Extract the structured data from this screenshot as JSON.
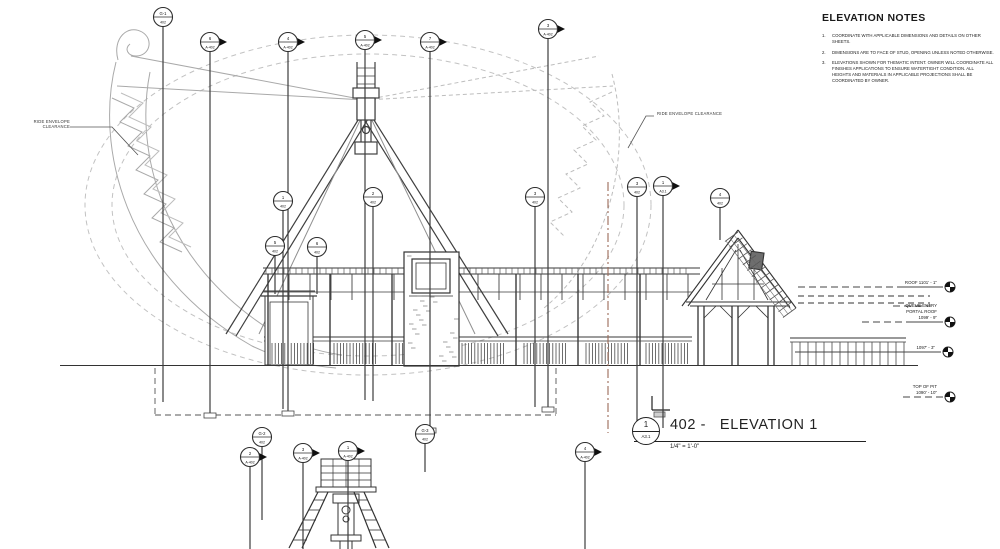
{
  "notes": {
    "title": "ELEVATION NOTES",
    "items": [
      {
        "num": "1.",
        "text": "COORDINATE WITH APPLICABLE DIMENSIONS AND DETAILS ON OTHER SHEETS."
      },
      {
        "num": "2.",
        "text": "DIMENSIONS ARE TO FACE OF STUD, OPENING UNLESS NOTED OTHERWISE."
      },
      {
        "num": "3.",
        "text": "ELEVATIONS SHOWN FOR THEMATIC INTENT.  OWNER WILL COORDINATE ALL FINISHES APPLICATIONS TO ENSURE WATERTIGHT CONDITION.  ALL HEIGHTS AND MATERIALS IN APPLICABLE PROJECTIONS SHALL BE COORDINATED BY OWNER."
      }
    ]
  },
  "labels": {
    "ride_envelope_left_line1": "RIDE ENVELOPE",
    "ride_envelope_left_line2": "CLEARANCE",
    "ride_envelope_right": "RIDE ENVELOPE CLEARANCE"
  },
  "title_block": {
    "detail_number": "1",
    "sheet_ref": "A3.1",
    "name": "402 -   ELEVATION 1",
    "scale": "1/4\" = 1'-0\""
  },
  "elevation_tags": [
    {
      "lines": [
        "ROOF 1101' - 1\""
      ],
      "x": 950,
      "y": 287
    },
    {
      "lines": [
        "QUEUE ENTRY",
        "PORTAL ROOF",
        "1099' - 9\""
      ],
      "x": 950,
      "y": 322
    },
    {
      "lines": [
        "1097' - 3\""
      ],
      "x": 948,
      "y": 352
    },
    {
      "lines": [
        "TOP OF PIT",
        "1090' - 10\""
      ],
      "x": 950,
      "y": 397
    }
  ],
  "markers": [
    {
      "kind": "grid",
      "top": "G-1",
      "bot": "402",
      "x": 163,
      "y": 17,
      "stem": 402
    },
    {
      "kind": "section",
      "top": "6",
      "bot": "A-402",
      "x": 210,
      "y": 42,
      "stem": 413,
      "box": true
    },
    {
      "kind": "section",
      "top": "4",
      "bot": "A-402",
      "x": 288,
      "y": 42,
      "stem": 411,
      "box": true
    },
    {
      "kind": "section",
      "top": "5",
      "bot": "A-402",
      "x": 365,
      "y": 40,
      "stem": 400
    },
    {
      "kind": "section",
      "top": "7",
      "bot": "A-402",
      "x": 430,
      "y": 42,
      "stem": 428,
      "box": true
    },
    {
      "kind": "section",
      "top": "3",
      "bot": "A-402",
      "x": 548,
      "y": 29,
      "stem": 407,
      "box": true
    },
    {
      "kind": "section",
      "top": "1",
      "bot": "A3.1",
      "x": 663,
      "y": 186,
      "stem": 428
    },
    {
      "kind": "grid",
      "top": "4",
      "bot": "402",
      "x": 720,
      "y": 198,
      "stem": 240
    },
    {
      "kind": "grid",
      "top": "1",
      "bot": "402",
      "x": 283,
      "y": 201,
      "stem": 409
    },
    {
      "kind": "grid",
      "top": "2",
      "bot": "402",
      "x": 373,
      "y": 197,
      "stem": 401
    },
    {
      "kind": "grid",
      "top": "3",
      "bot": "402",
      "x": 535,
      "y": 197,
      "stem": 407
    },
    {
      "kind": "grid",
      "top": "3",
      "bot": "402",
      "x": 637,
      "y": 187,
      "stem": 428
    },
    {
      "kind": "grid",
      "top": "5",
      "bot": "402",
      "x": 275,
      "y": 246,
      "stem": 294
    },
    {
      "kind": "grid",
      "top": "6",
      "bot": "402",
      "x": 317,
      "y": 247,
      "stem": 294
    },
    {
      "kind": "grid",
      "top": "G-2",
      "bot": "402",
      "x": 262,
      "y": 437,
      "stem": 520
    },
    {
      "kind": "section",
      "top": "2",
      "bot": "A-402",
      "x": 250,
      "y": 457,
      "stem": 549
    },
    {
      "kind": "section",
      "top": "3",
      "bot": "A-402",
      "x": 303,
      "y": 453,
      "stem": 549
    },
    {
      "kind": "section",
      "top": "1",
      "bot": "A-402",
      "x": 348,
      "y": 451,
      "stem": 549
    },
    {
      "kind": "grid",
      "top": "G-3",
      "bot": "402",
      "x": 425,
      "y": 434,
      "stem": 472
    },
    {
      "kind": "section",
      "top": "4",
      "bot": "A-402",
      "x": 585,
      "y": 452,
      "stem": 549
    }
  ],
  "colors": {
    "line": "#333333",
    "light_line": "#a9a9a9",
    "envelope": "#c2c2c2",
    "scope_line": "#9a6a58",
    "marker_fill": "#101010",
    "background": "#ffffff"
  }
}
